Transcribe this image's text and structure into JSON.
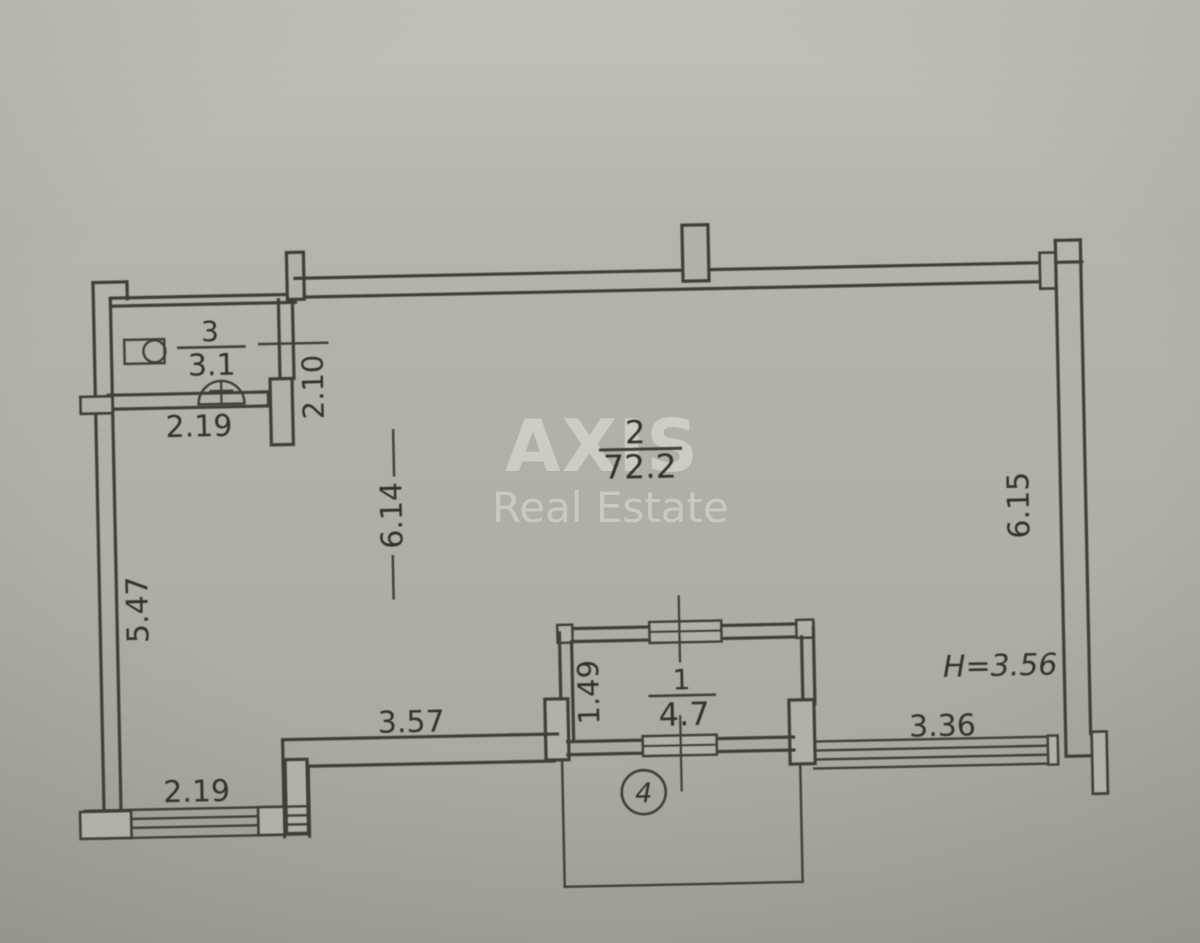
{
  "watermark": {
    "brand": "AXIS",
    "subtitle": "Real Estate"
  },
  "rooms": {
    "bathroom": {
      "number": "3",
      "area": "3.1"
    },
    "living": {
      "number": "2",
      "area": "72.2"
    },
    "balcony": {
      "number": "1",
      "area": "4.7"
    },
    "balcony_zone": {
      "number": "4"
    }
  },
  "dimensions": {
    "bathroom_width": "2.19",
    "hall_length": "2.10",
    "room_width": "6.14",
    "left_wall": "5.47",
    "right_wall": "6.15",
    "balcony_depth": "1.49",
    "bottom_left": "3.57",
    "bottom_right": "3.36",
    "facade_left": "2.19",
    "ceiling_height": "H=3.56"
  },
  "colors": {
    "paper": "#b3b0a9",
    "ink": "#413e38",
    "watermark": "#eae7de"
  }
}
